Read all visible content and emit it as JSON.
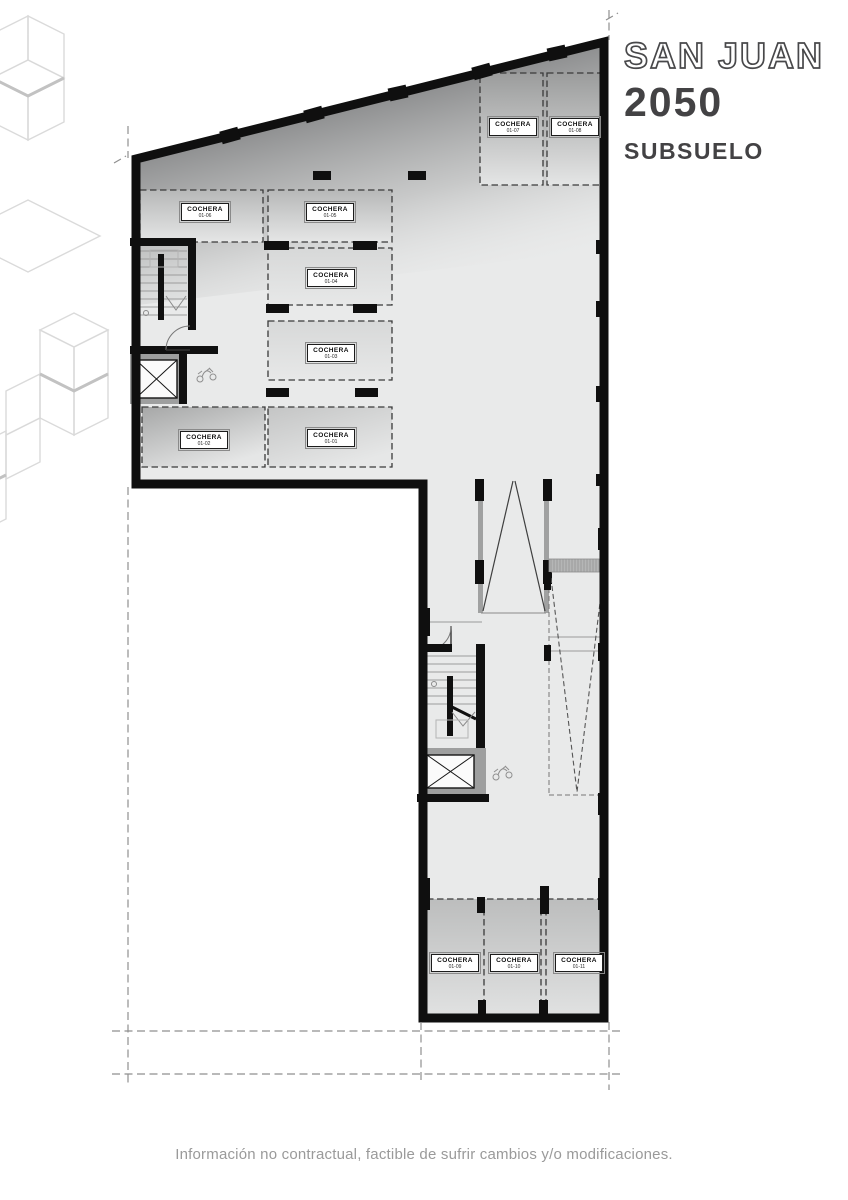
{
  "title": {
    "project": "SAN JUAN",
    "number": "2050",
    "level": "SUBSUELO"
  },
  "plan": {
    "stalls": [
      {
        "name": "COCHERA",
        "code": "01-01"
      },
      {
        "name": "COCHERA",
        "code": "01-02"
      },
      {
        "name": "COCHERA",
        "code": "01-03"
      },
      {
        "name": "COCHERA",
        "code": "01-04"
      },
      {
        "name": "COCHERA",
        "code": "01-05"
      },
      {
        "name": "COCHERA",
        "code": "01-06"
      },
      {
        "name": "COCHERA",
        "code": "01-07"
      },
      {
        "name": "COCHERA",
        "code": "01-08"
      },
      {
        "name": "COCHERA",
        "code": "01-09"
      },
      {
        "name": "COCHERA",
        "code": "01-10"
      },
      {
        "name": "COCHERA",
        "code": "01-11"
      }
    ]
  },
  "footer": {
    "disclaimer": "Información no contractual, factible de sufrir cambios y/o modificaciones."
  },
  "colors": {
    "wall": "#0f0f0f",
    "floor": "#e9eaea",
    "accent_text": "#434244",
    "reference_line": "#8f8f8f"
  }
}
